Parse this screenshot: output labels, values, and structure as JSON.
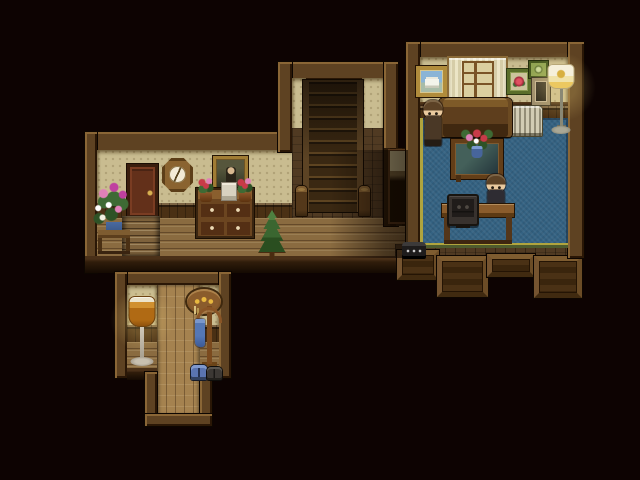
{
  "meta": {
    "app": "rpg-house-interior-scene",
    "width": 640,
    "height": 480
  },
  "palette": {
    "bg": "#0D0302",
    "beam": "#5E4222",
    "beam_hi": "#8A6636",
    "beam_lo": "#2A1706",
    "wallpaper": "#C9BC90",
    "wainscot": "#4A3014",
    "floor": "#8A6B40",
    "entry_floor": "#A5824F",
    "carpet": "#346282",
    "carpet_gold": "#B0A43E",
    "carpet_green": "#4E5C2E",
    "stairs": "#3A2812",
    "door": "#63301A",
    "hair": "#5C4226",
    "skin": "#E9C99E",
    "char1_coat": "#4A3826",
    "char2_coat": "#2E2C32",
    "flower_red": "#C83A48",
    "flower_pink": "#E080B8",
    "flower_magenta": "#C040A0",
    "plant_green": "#3E6A34",
    "vase_blue": "#4A6AA0"
  },
  "scene": {
    "objects": [
      {
        "name": "hall-top-wall",
        "cls": "beam",
        "x": 85,
        "y": 132,
        "w": 207,
        "h": 20,
        "interactable": false
      },
      {
        "name": "hall-left-wall",
        "cls": "beam",
        "x": 85,
        "y": 132,
        "w": 12,
        "h": 141,
        "interactable": false
      },
      {
        "name": "hall-wallpaper",
        "cls": "wallpaper",
        "x": 97,
        "y": 150,
        "w": 205,
        "h": 56,
        "interactable": false
      },
      {
        "name": "hall-wainscot",
        "cls": "wainscot",
        "x": 97,
        "y": 203,
        "w": 205,
        "h": 17,
        "interactable": false
      },
      {
        "name": "hall-floor",
        "cls": "floor-h",
        "x": 97,
        "y": 218,
        "w": 323,
        "h": 40,
        "interactable": false
      },
      {
        "name": "hall-front-wall",
        "cls": "front-wall",
        "x": 85,
        "y": 256,
        "w": 315,
        "h": 17,
        "interactable": false
      },
      {
        "name": "stair-hall-top-wall",
        "cls": "beam",
        "x": 278,
        "y": 62,
        "w": 120,
        "h": 18,
        "interactable": false
      },
      {
        "name": "stair-hall-left-wall",
        "cls": "beam",
        "x": 278,
        "y": 62,
        "w": 14,
        "h": 90,
        "interactable": false
      },
      {
        "name": "stair-wallpaper-left",
        "cls": "wallpaper",
        "x": 292,
        "y": 78,
        "w": 14,
        "h": 62,
        "interactable": false
      },
      {
        "name": "stair-wallpaper-right",
        "cls": "wallpaper",
        "x": 362,
        "y": 78,
        "w": 22,
        "h": 62,
        "interactable": false
      },
      {
        "name": "stair-floor",
        "cls": "floor-dim",
        "x": 292,
        "y": 128,
        "w": 92,
        "h": 90,
        "interactable": false
      },
      {
        "name": "staircase-up",
        "cls": "stairs",
        "x": 303,
        "y": 80,
        "w": 60,
        "h": 132,
        "interactable": true
      },
      {
        "name": "newel-post-left",
        "cls": "newel",
        "x": 296,
        "y": 186,
        "w": 11,
        "h": 30,
        "interactable": false
      },
      {
        "name": "newel-post-right",
        "cls": "newel",
        "x": 359,
        "y": 186,
        "w": 11,
        "h": 30,
        "interactable": false
      },
      {
        "name": "stair-hall-right-wall",
        "cls": "beam",
        "x": 384,
        "y": 62,
        "w": 14,
        "h": 164,
        "interactable": false
      },
      {
        "name": "hall-east-wall",
        "cls": "wall-dark",
        "x": 384,
        "y": 148,
        "w": 24,
        "h": 78,
        "interactable": false
      },
      {
        "name": "hall-east-doorway",
        "cls": "doorway",
        "x": 390,
        "y": 151,
        "w": 16,
        "h": 71,
        "interactable": true
      },
      {
        "name": "right-room-floor-edge",
        "cls": "floor-dim",
        "x": 395,
        "y": 244,
        "w": 187,
        "h": 14,
        "interactable": false
      },
      {
        "name": "porch-panel-a",
        "cls": "wood-panel",
        "x": 397,
        "y": 250,
        "w": 42,
        "h": 30,
        "interactable": false
      },
      {
        "name": "porch-panel-b",
        "cls": "wood-panel",
        "x": 437,
        "y": 256,
        "w": 51,
        "h": 41,
        "interactable": false
      },
      {
        "name": "porch-panel-c",
        "cls": "wood-panel",
        "x": 487,
        "y": 254,
        "w": 48,
        "h": 23,
        "interactable": false
      },
      {
        "name": "porch-panel-d",
        "cls": "wood-panel",
        "x": 534,
        "y": 256,
        "w": 48,
        "h": 42,
        "interactable": false
      },
      {
        "name": "right-room-top-wall",
        "cls": "beam",
        "x": 406,
        "y": 42,
        "w": 178,
        "h": 17,
        "interactable": false
      },
      {
        "name": "right-room-left-wall",
        "cls": "beam",
        "x": 406,
        "y": 42,
        "w": 14,
        "h": 216,
        "interactable": false
      },
      {
        "name": "right-room-right-wall",
        "cls": "beam",
        "x": 568,
        "y": 42,
        "w": 16,
        "h": 216,
        "interactable": false
      },
      {
        "name": "right-room-wallpaper",
        "cls": "wallpaper",
        "x": 420,
        "y": 57,
        "w": 148,
        "h": 49,
        "interactable": false
      },
      {
        "name": "right-room-picture-rail",
        "cls": "rail",
        "x": 420,
        "y": 102,
        "w": 148,
        "h": 5,
        "interactable": false
      },
      {
        "name": "right-room-wainscot",
        "cls": "wainscot",
        "x": 420,
        "y": 106,
        "w": 148,
        "h": 16,
        "interactable": false
      },
      {
        "name": "right-room-carpet",
        "cls": "carpet",
        "x": 420,
        "y": 118,
        "w": 148,
        "h": 130,
        "interactable": false
      },
      {
        "name": "entry-top-wall",
        "cls": "beam",
        "x": 115,
        "y": 272,
        "w": 116,
        "h": 13,
        "interactable": false
      },
      {
        "name": "entry-left-wall",
        "cls": "beam",
        "x": 115,
        "y": 272,
        "w": 12,
        "h": 106,
        "interactable": false
      },
      {
        "name": "entry-right-wall",
        "cls": "beam",
        "x": 219,
        "y": 272,
        "w": 12,
        "h": 106,
        "interactable": false
      },
      {
        "name": "entry-wallpaper-left",
        "cls": "wallpaper",
        "x": 127,
        "y": 285,
        "w": 30,
        "h": 42,
        "interactable": false
      },
      {
        "name": "entry-wallpaper-right",
        "cls": "wallpaper",
        "x": 200,
        "y": 285,
        "w": 19,
        "h": 42,
        "interactable": false
      },
      {
        "name": "entry-wainscot-left",
        "cls": "wainscot",
        "x": 127,
        "y": 325,
        "w": 30,
        "h": 17,
        "interactable": false
      },
      {
        "name": "entry-wainscot-right",
        "cls": "wainscot",
        "x": 200,
        "y": 325,
        "w": 19,
        "h": 17,
        "interactable": false
      },
      {
        "name": "entry-floor-left",
        "cls": "floor-h",
        "x": 127,
        "y": 342,
        "w": 30,
        "h": 36,
        "interactable": false
      },
      {
        "name": "entry-floor-right",
        "cls": "floor-h",
        "x": 200,
        "y": 342,
        "w": 19,
        "h": 36,
        "interactable": false
      },
      {
        "name": "entry-hall-floor",
        "cls": "floor-v",
        "x": 157,
        "y": 285,
        "w": 43,
        "h": 130,
        "interactable": true
      },
      {
        "name": "entry-front-wall-left",
        "cls": "front-wall",
        "x": 127,
        "y": 368,
        "w": 30,
        "h": 12,
        "interactable": false
      },
      {
        "name": "entry-front-wall-right",
        "cls": "front-wall",
        "x": 200,
        "y": 368,
        "w": 19,
        "h": 12,
        "interactable": false
      },
      {
        "name": "entry-stub-left-wall",
        "cls": "beam",
        "x": 145,
        "y": 372,
        "w": 12,
        "h": 54,
        "interactable": false
      },
      {
        "name": "entry-stub-right-wall",
        "cls": "beam",
        "x": 200,
        "y": 372,
        "w": 12,
        "h": 54,
        "interactable": false
      },
      {
        "name": "entry-stub-bottom-wall",
        "cls": "beam",
        "x": 145,
        "y": 414,
        "w": 67,
        "h": 12,
        "interactable": false
      },
      {
        "name": "hall-door",
        "cls": "door",
        "x": 127,
        "y": 164,
        "w": 31,
        "h": 54,
        "interactable": true
      },
      {
        "name": "wall-clock",
        "cls": "clock",
        "x": 162,
        "y": 158,
        "w": 31,
        "h": 34,
        "interactable": true
      },
      {
        "name": "hall-portrait",
        "cls": "portrait",
        "x": 213,
        "y": 156,
        "w": 35,
        "h": 37,
        "interactable": false
      },
      {
        "name": "hall-steps-down",
        "cls": "steps",
        "x": 122,
        "y": 216,
        "w": 38,
        "h": 40,
        "interactable": true
      },
      {
        "name": "flower-stand",
        "cls": "flower-stand",
        "x": 92,
        "y": 178,
        "w": 44,
        "h": 76,
        "interactable": false
      },
      {
        "name": "hall-dresser",
        "cls": "dresser",
        "x": 196,
        "y": 188,
        "w": 58,
        "h": 50,
        "interactable": true
      },
      {
        "name": "dresser-flowers-left",
        "cls": "potted-flowers",
        "x": 196,
        "y": 176,
        "w": 20,
        "h": 26,
        "interactable": false
      },
      {
        "name": "dresser-book",
        "cls": "book",
        "x": 221,
        "y": 182,
        "w": 16,
        "h": 19,
        "interactable": false
      },
      {
        "name": "dresser-flowers-right",
        "cls": "potted-flowers",
        "x": 235,
        "y": 176,
        "w": 20,
        "h": 26,
        "interactable": false
      },
      {
        "name": "pine-tree",
        "cls": "pine",
        "x": 257,
        "y": 210,
        "w": 30,
        "h": 50,
        "interactable": false
      },
      {
        "name": "hall-shadow",
        "cls": "shade-r",
        "x": 330,
        "y": 150,
        "w": 78,
        "h": 108,
        "interactable": false
      },
      {
        "name": "telephone",
        "cls": "phone",
        "x": 402,
        "y": 242,
        "w": 24,
        "h": 16,
        "interactable": true
      },
      {
        "name": "painting-building",
        "cls": "painting-building",
        "x": 416,
        "y": 66,
        "w": 31,
        "h": 31,
        "interactable": false
      },
      {
        "name": "window",
        "cls": "window",
        "x": 449,
        "y": 58,
        "w": 57,
        "h": 46,
        "interactable": true
      },
      {
        "name": "rose-picture",
        "cls": "rose-picture",
        "x": 507,
        "y": 69,
        "w": 24,
        "h": 25,
        "interactable": false
      },
      {
        "name": "green-picture",
        "cls": "green-picture",
        "x": 529,
        "y": 61,
        "w": 19,
        "h": 17,
        "interactable": false
      },
      {
        "name": "small-frame",
        "cls": "tan-frame",
        "x": 532,
        "y": 78,
        "w": 18,
        "h": 27,
        "interactable": false
      },
      {
        "name": "radiator",
        "cls": "radiator",
        "x": 511,
        "y": 106,
        "w": 31,
        "h": 30,
        "interactable": false
      },
      {
        "name": "lamp-glow-white",
        "cls": "glow",
        "x": 526,
        "y": 52,
        "w": 70,
        "h": 70,
        "interactable": false
      },
      {
        "name": "floor-lamp-white",
        "cls": "lamp-white",
        "x": 546,
        "y": 64,
        "w": 30,
        "h": 70,
        "interactable": true
      },
      {
        "name": "couch",
        "cls": "couch",
        "x": 439,
        "y": 98,
        "w": 73,
        "h": 39,
        "interactable": true
      },
      {
        "name": "character-standing",
        "cls": "char char1",
        "x": 420,
        "y": 100,
        "w": 25,
        "h": 46,
        "interactable": true
      },
      {
        "name": "coffee-table",
        "cls": "coffee-table",
        "x": 451,
        "y": 139,
        "w": 52,
        "h": 40,
        "interactable": false
      },
      {
        "name": "table-bouquet",
        "cls": "bouquet",
        "x": 458,
        "y": 124,
        "w": 38,
        "h": 34,
        "interactable": false
      },
      {
        "name": "character-at-desk",
        "cls": "char char2",
        "x": 485,
        "y": 174,
        "w": 22,
        "h": 40,
        "interactable": true
      },
      {
        "name": "computer-desk",
        "cls": "desk",
        "x": 442,
        "y": 204,
        "w": 72,
        "h": 40,
        "interactable": true
      },
      {
        "name": "monitor",
        "cls": "monitor",
        "x": 447,
        "y": 194,
        "w": 32,
        "h": 32,
        "interactable": true
      },
      {
        "name": "lamp-glow-amber",
        "cls": "glow",
        "x": 110,
        "y": 288,
        "w": 64,
        "h": 64,
        "interactable": false
      },
      {
        "name": "floor-lamp-amber",
        "cls": "lamp-amber",
        "x": 127,
        "y": 296,
        "w": 30,
        "h": 70,
        "interactable": true
      },
      {
        "name": "key-holder",
        "cls": "key-plaque",
        "x": 187,
        "y": 289,
        "w": 34,
        "h": 25,
        "interactable": true
      },
      {
        "name": "coat-rack",
        "cls": "coat-rack",
        "x": 193,
        "y": 306,
        "w": 32,
        "h": 66,
        "interactable": true
      },
      {
        "name": "shoes-blue",
        "cls": "shoes shoes-blue",
        "x": 191,
        "y": 365,
        "w": 16,
        "h": 15,
        "interactable": false
      },
      {
        "name": "shoes-dark",
        "cls": "shoes shoes-dark",
        "x": 207,
        "y": 367,
        "w": 15,
        "h": 13,
        "interactable": false
      }
    ]
  }
}
